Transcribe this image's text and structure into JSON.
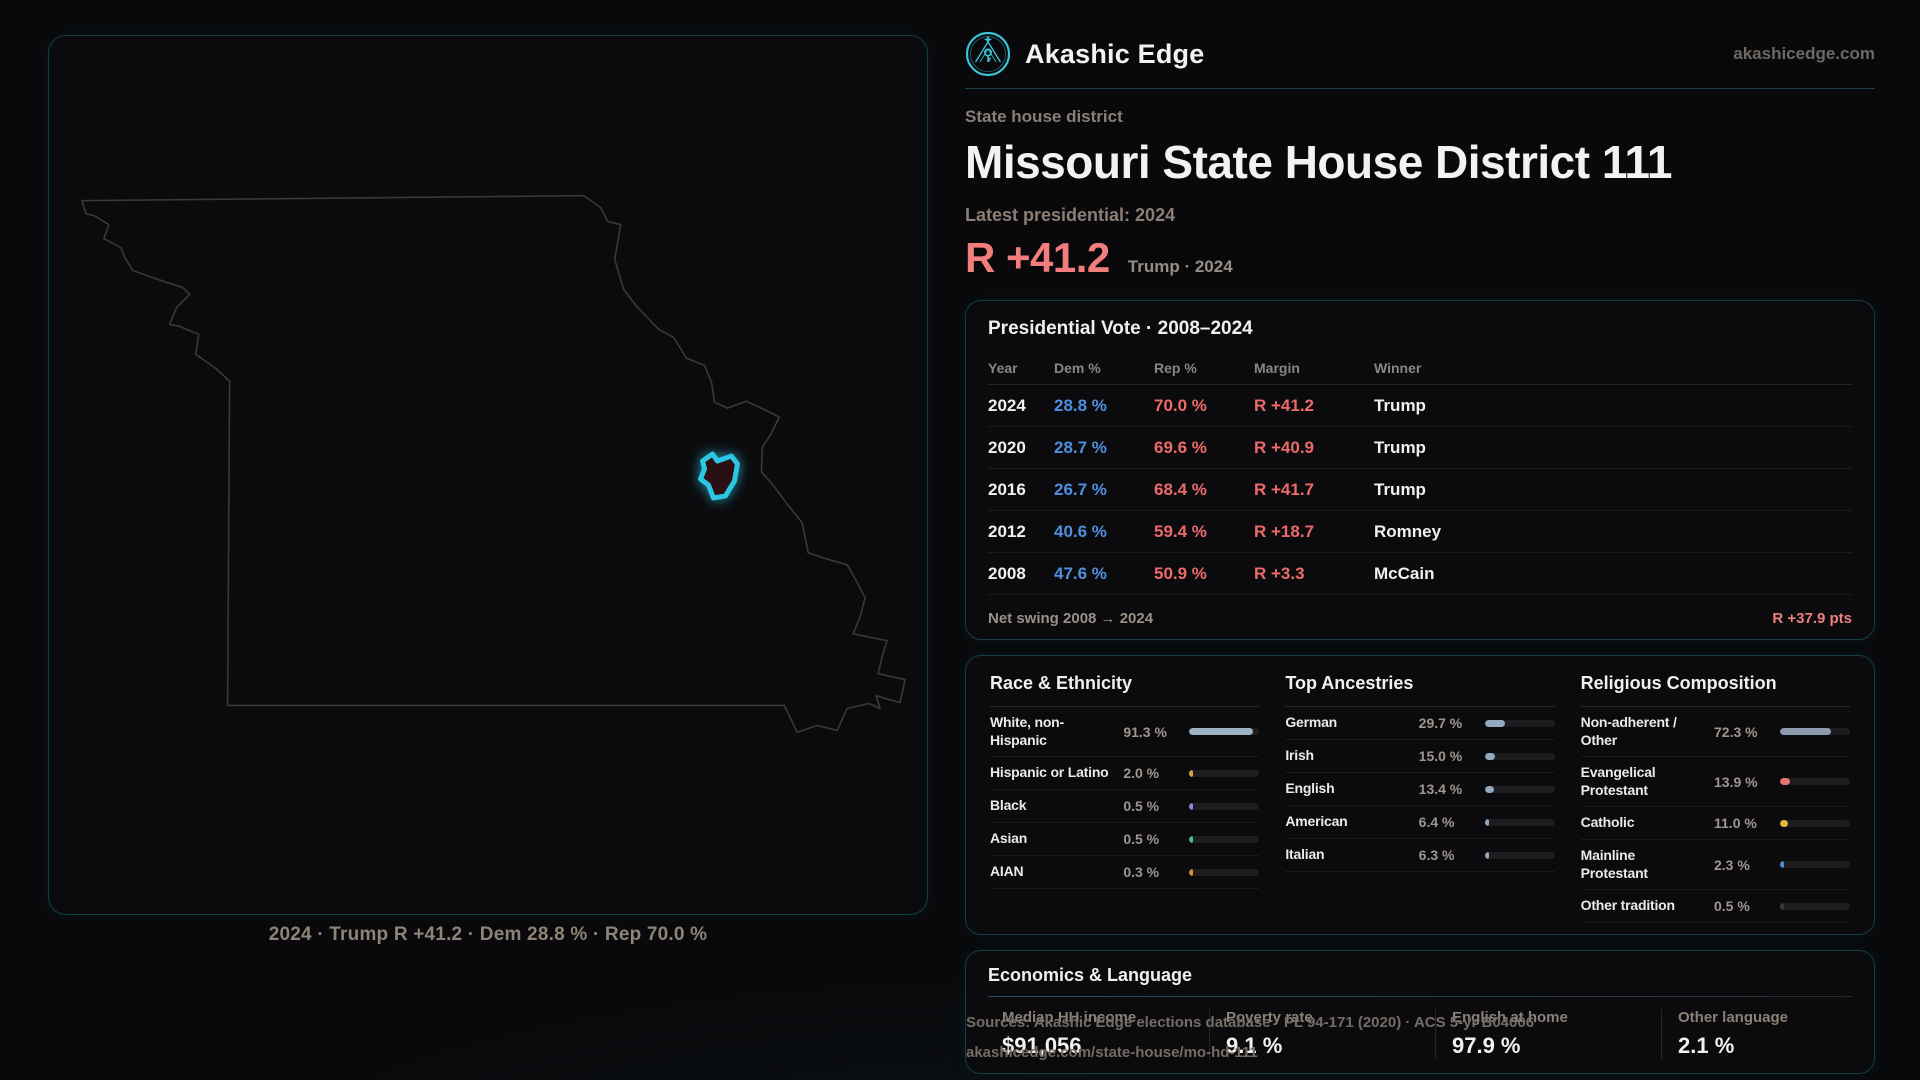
{
  "theme": {
    "accent_teal": "#2cc5e2",
    "dem_blue": "#4f8fdf",
    "rep_red": "#ed6a6a",
    "headline_red": "#f17d7d"
  },
  "brand": {
    "name": "Akashic Edge",
    "domain": "akashicedge.com",
    "logo_icon": "akashic-edge-emblem-icon"
  },
  "page": {
    "eyebrow": "State house district",
    "title": "Missouri State House District 111",
    "latest_label": "Latest presidential: 2024",
    "headline_margin": "R +41.2",
    "headline_context": "Trump · 2024"
  },
  "map": {
    "caption": "2024 · Trump R +41.2 · Dem 28.8 % · Rep 70.0 %",
    "state": "Missouri",
    "district_highlight_color": "#2cc5e2"
  },
  "pres_table": {
    "title": "Presidential Vote · 2008–2024",
    "columns": [
      "Year",
      "Dem %",
      "Rep %",
      "Margin",
      "Winner"
    ],
    "rows": [
      {
        "year": "2024",
        "dem": "28.8 %",
        "rep": "70.0 %",
        "margin": "R +41.2",
        "winner": "Trump"
      },
      {
        "year": "2020",
        "dem": "28.7 %",
        "rep": "69.6 %",
        "margin": "R +40.9",
        "winner": "Trump"
      },
      {
        "year": "2016",
        "dem": "26.7 %",
        "rep": "68.4 %",
        "margin": "R +41.7",
        "winner": "Trump"
      },
      {
        "year": "2012",
        "dem": "40.6 %",
        "rep": "59.4 %",
        "margin": "R +18.7",
        "winner": "Romney"
      },
      {
        "year": "2008",
        "dem": "47.6 %",
        "rep": "50.9 %",
        "margin": "R +3.3",
        "winner": "McCain"
      }
    ],
    "net_swing_label": "Net swing 2008 → 2024",
    "net_swing_value": "R +37.9 pts"
  },
  "race": {
    "title": "Race & Ethnicity",
    "rows": [
      {
        "label": "White, non-Hispanic",
        "value": "91.3 %",
        "pct": 91.3,
        "color": "#9db2c4"
      },
      {
        "label": "Hispanic or Latino",
        "value": "2.0 %",
        "pct": 2.0,
        "color": "#e2a43e"
      },
      {
        "label": "Black",
        "value": "0.5 %",
        "pct": 0.5,
        "color": "#8f86e0"
      },
      {
        "label": "Asian",
        "value": "0.5 %",
        "pct": 0.5,
        "color": "#43b99a"
      },
      {
        "label": "AIAN",
        "value": "0.3 %",
        "pct": 0.3,
        "color": "#d98a3a"
      }
    ]
  },
  "ancestries": {
    "title": "Top Ancestries",
    "rows": [
      {
        "label": "German",
        "value": "29.7 %",
        "pct": 29.7,
        "color": "#93a9bd"
      },
      {
        "label": "Irish",
        "value": "15.0 %",
        "pct": 15.0,
        "color": "#93a9bd"
      },
      {
        "label": "English",
        "value": "13.4 %",
        "pct": 13.4,
        "color": "#93a9bd"
      },
      {
        "label": "American",
        "value": "6.4 %",
        "pct": 6.4,
        "color": "#93a9bd"
      },
      {
        "label": "Italian",
        "value": "6.3 %",
        "pct": 6.3,
        "color": "#93a9bd"
      }
    ]
  },
  "religion": {
    "title": "Religious Composition",
    "rows": [
      {
        "label": "Non-adherent / Other",
        "value": "72.3 %",
        "pct": 72.3,
        "color": "#8d9aae"
      },
      {
        "label": "Evangelical Protestant",
        "value": "13.9 %",
        "pct": 13.9,
        "color": "#e57373"
      },
      {
        "label": "Catholic",
        "value": "11.0 %",
        "pct": 11.0,
        "color": "#e4b83c"
      },
      {
        "label": "Mainline Protestant",
        "value": "2.3 %",
        "pct": 2.3,
        "color": "#4d8fd1"
      },
      {
        "label": "Other tradition",
        "value": "0.5 %",
        "pct": 0.5,
        "color": "#3a3a3f"
      }
    ]
  },
  "econ": {
    "title": "Economics & Language",
    "stats": [
      {
        "label": "Median HH income",
        "value": "$91,056"
      },
      {
        "label": "Poverty rate",
        "value": "9.1 %"
      },
      {
        "label": "English at home",
        "value": "97.9 %"
      },
      {
        "label": "Other language",
        "value": "2.1 %"
      }
    ]
  },
  "sources": {
    "line1": "Sources: Akashic Edge elections database · PL 94-171 (2020) · ACS 5-yr B04006",
    "line2": "akashicedge.com/state-house/mo-hd-111"
  }
}
